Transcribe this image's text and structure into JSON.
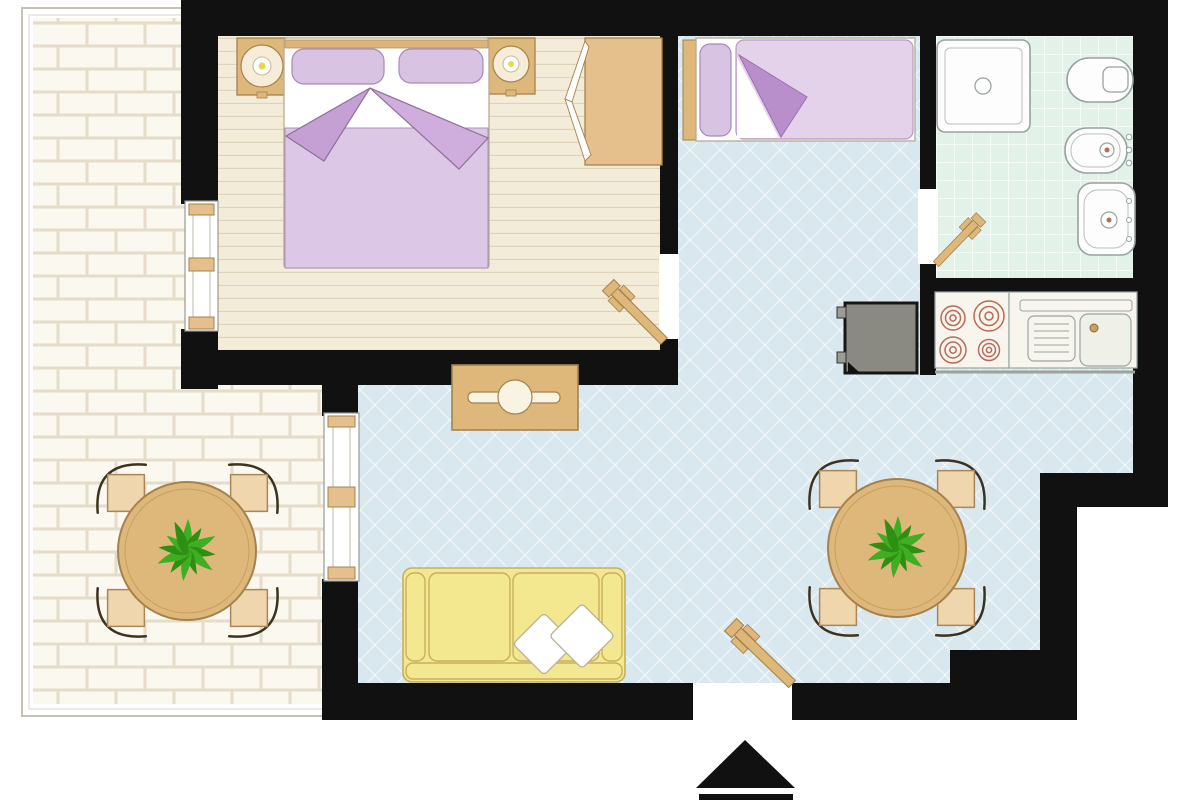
{
  "document": {
    "kind": "apartment floor plan drawing",
    "view": "top-down architectural plan",
    "background": "#ffffff",
    "entrance_marker": "black triangle arrow pointing up with base bar, below entrance door"
  },
  "palette": {
    "wall": "#111111",
    "bedroom_floor": "#f3ecd9",
    "plank_line": "#dbd1b8",
    "living_floor": "#d9e8ef",
    "bath_floor": "#e3f2e9",
    "brick": "#fbf8ef",
    "mortar": "#e5ddca",
    "terrace_frame": "#c6c2b4",
    "wood": "#ddb87a",
    "wood_dark": "#a5824d",
    "chair_seat": "#f0d6ac",
    "lavender": "#dcc7e6",
    "lavender_fold_left": "#c5a0d4",
    "lavender_fold_right": "#cfaede",
    "pillow": "#d9c3e3",
    "single_blanket": "#e4d2ea",
    "single_fold": "#b98fcb",
    "sofa": "#f3e88f",
    "sofa_line": "#c6b060",
    "cushion": "#ffffff",
    "fixture": "#fdfdfd",
    "fixture_line": "#98a2a0",
    "fridge": "#8a8a82",
    "burner_ring": "#b96a55",
    "plant_light": "#3fae22",
    "plant_dark": "#2f8f12",
    "arrow": "#111111"
  },
  "rooms": [
    {
      "id": "bedroom",
      "label": "double bedroom",
      "floor": "wood planks",
      "furniture": [
        "double bed",
        "pillows x2",
        "folded duvet",
        "nightstand with lamp x2",
        "wardrobe with open doors",
        "hinged door"
      ]
    },
    {
      "id": "single-bed-nook",
      "label": "single bed nook",
      "floor": "diagonal tile",
      "furniture": [
        "single bed",
        "pillow",
        "folded duvet",
        "wood headboard"
      ]
    },
    {
      "id": "bathroom",
      "label": "bathroom",
      "floor": "green tile grid",
      "furniture": [
        "shower tray with drain",
        "toilet with cistern",
        "bidet with taps",
        "washbasin with taps",
        "hinged door"
      ]
    },
    {
      "id": "kitchen",
      "label": "kitchenette",
      "floor": "diagonal tile",
      "furniture": [
        "refrigerator",
        "stove with 4 burners",
        "drawer unit",
        "counter sink with faucet"
      ]
    },
    {
      "id": "living-room",
      "label": "living / dining room",
      "floor": "diagonal tile",
      "furniture": [
        "console desk with stool",
        "three-seat sofa",
        "white cushions x2",
        "round dining table",
        "potted plant",
        "chairs x4",
        "entrance door"
      ]
    },
    {
      "id": "terrace",
      "label": "terrace",
      "floor": "brick paving",
      "furniture": [
        "round table",
        "potted plant",
        "chairs x4"
      ]
    }
  ],
  "openings": {
    "windows": [
      "bedroom window in left wall",
      "living room french window to terrace"
    ],
    "doors": [
      "bedroom hinged door",
      "bathroom hinged door",
      "entrance hinged door"
    ]
  },
  "icons": {
    "entrance_arrow": "filled up-pointing triangle with bar"
  }
}
